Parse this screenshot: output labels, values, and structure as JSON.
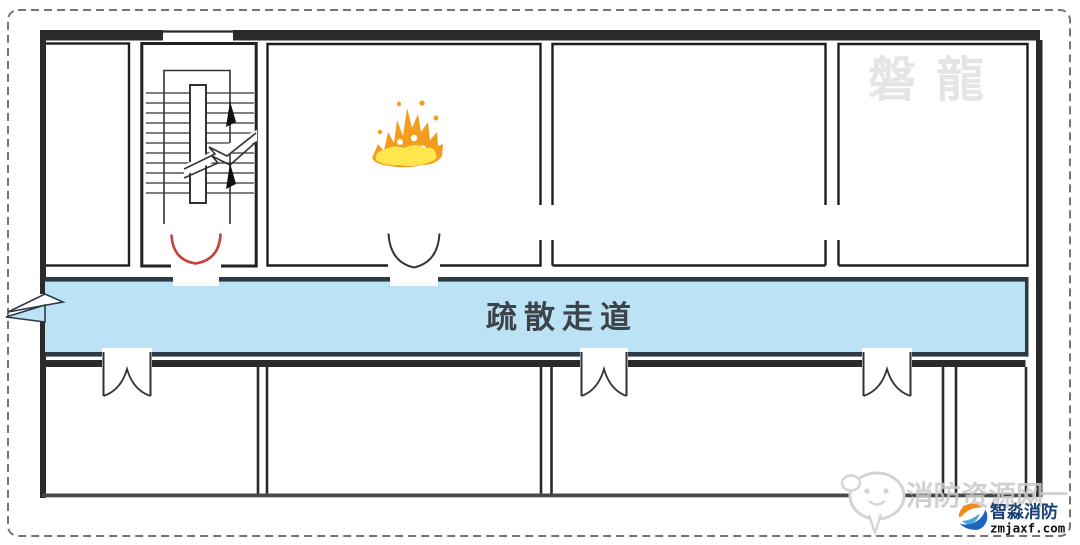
{
  "floor_plan": {
    "corridor_label": "疏散走道",
    "watermarks": {
      "top_right": "磐龍",
      "bottom_right": "消防资源网",
      "bottom_right_dash": "—"
    },
    "brand": {
      "name": "智淼消防",
      "domain": "zmjaxf.com"
    },
    "icons": {
      "fire": "fire-icon",
      "staircase": "staircase-symbol",
      "up_arrows": "up-arrow-icon",
      "break_line": "break-line-symbol",
      "fire_door": "double-fire-door-symbol",
      "double_door": "double-swing-door-symbol",
      "chat_bubble": "chat-bubble-icon",
      "brand_logo": "brand-logo-icon"
    },
    "colors": {
      "corridor_fill": "#BCE2F5",
      "corridor_edge": "#2C3A47",
      "wall": "#2B2B2B",
      "room_line": "#1E1E1E",
      "fire_door_red": "#C4423C",
      "flame_orange": "#F49D1C",
      "flame_yellow": "#FFE64D",
      "watermark_light": "#E5E5E5",
      "watermark_gray": "#C9C9C9",
      "logo_blue": "#1B64C0",
      "logo_light_blue": "#4BA3DC",
      "logo_orange": "#F08A1D",
      "brand_text_blue": "#173E75",
      "corridor_label_color": "#3E434A"
    }
  }
}
